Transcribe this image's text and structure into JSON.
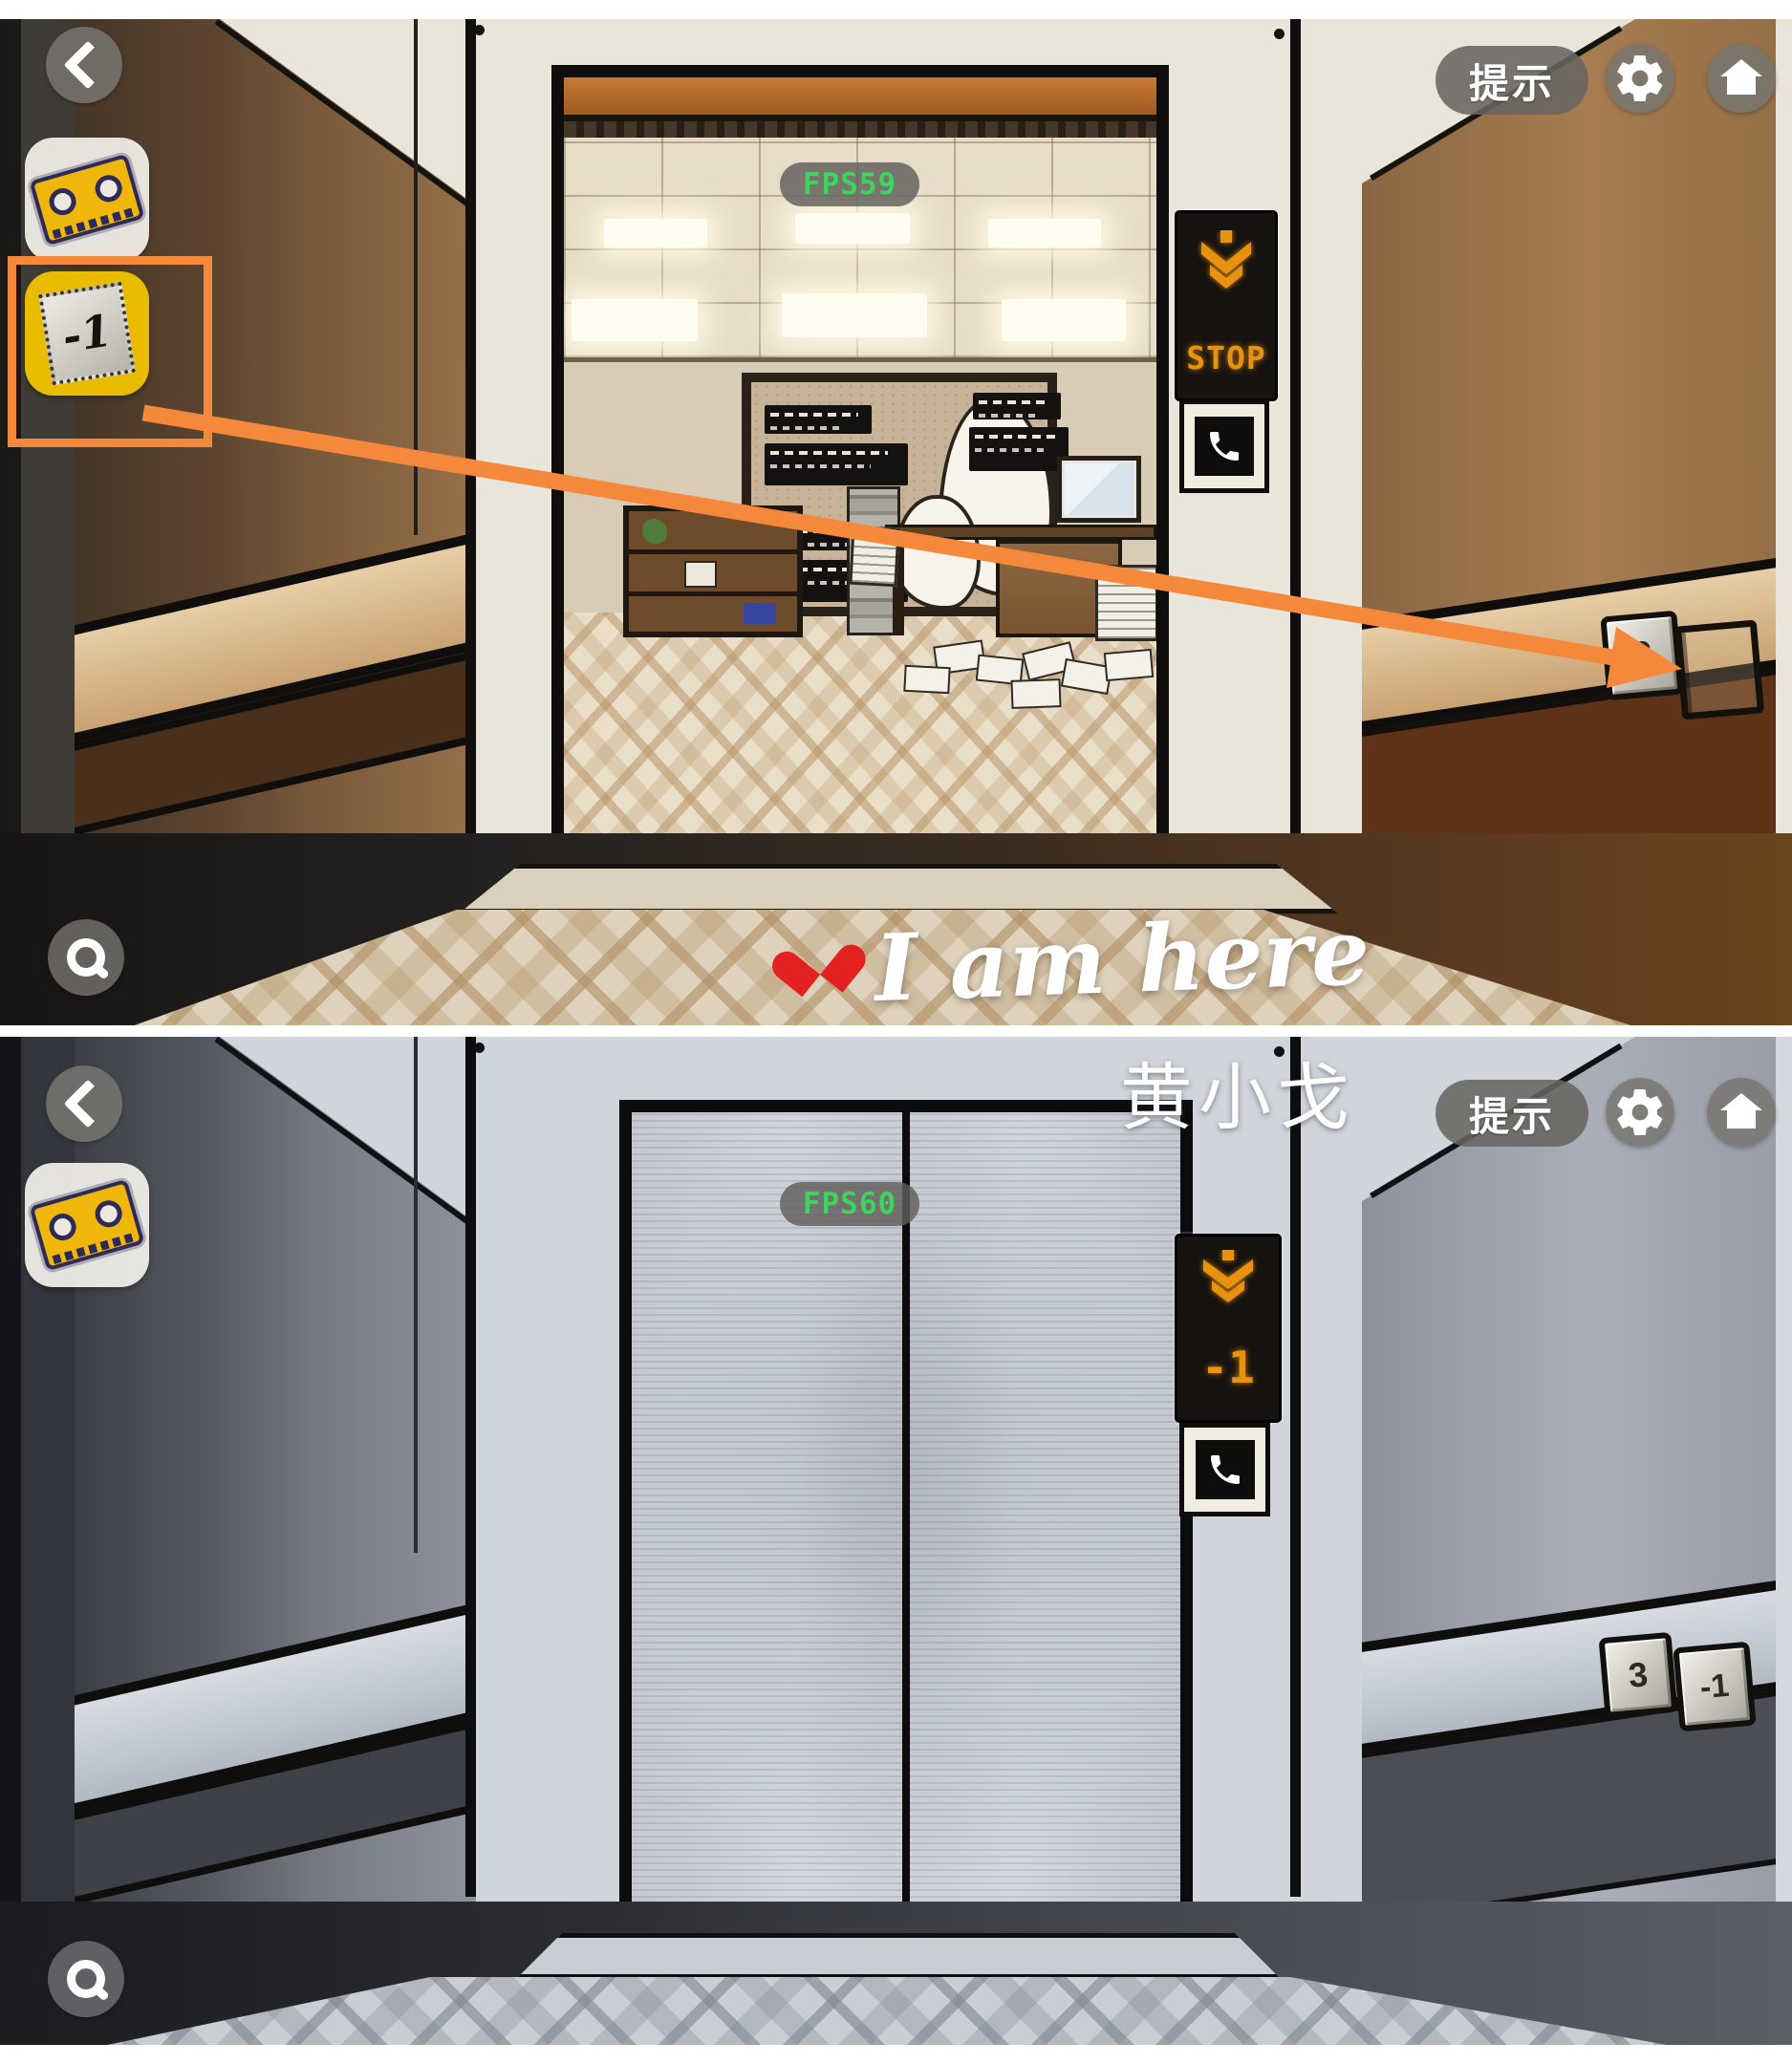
{
  "icons": {
    "back": "chevron-left",
    "hint": "hint-pill",
    "settings": "gear",
    "home": "house",
    "zoom": "magnifier",
    "phone": "telephone-receiver",
    "elevator_direction": "down-arrow",
    "heart": "red-heart"
  },
  "colors": {
    "annotation_orange": "#F5893B",
    "led_orange": "#E8920F",
    "fps_green": "#3FD45E",
    "selected_slot_yellow": "#E9BC00"
  },
  "shared_ui": {
    "hint_label": "提示"
  },
  "top_panel": {
    "fps_label": "FPS59",
    "display_sign": "STOP",
    "floor_button_3": "3",
    "inventory_minus_one": "-1",
    "caption_text": "I am here"
  },
  "bottom_panel": {
    "fps_label": "FPS60",
    "display_sign": "-1",
    "floor_button_3": "3",
    "floor_button_minus_one": "-1",
    "watermark": "黄小戈"
  }
}
